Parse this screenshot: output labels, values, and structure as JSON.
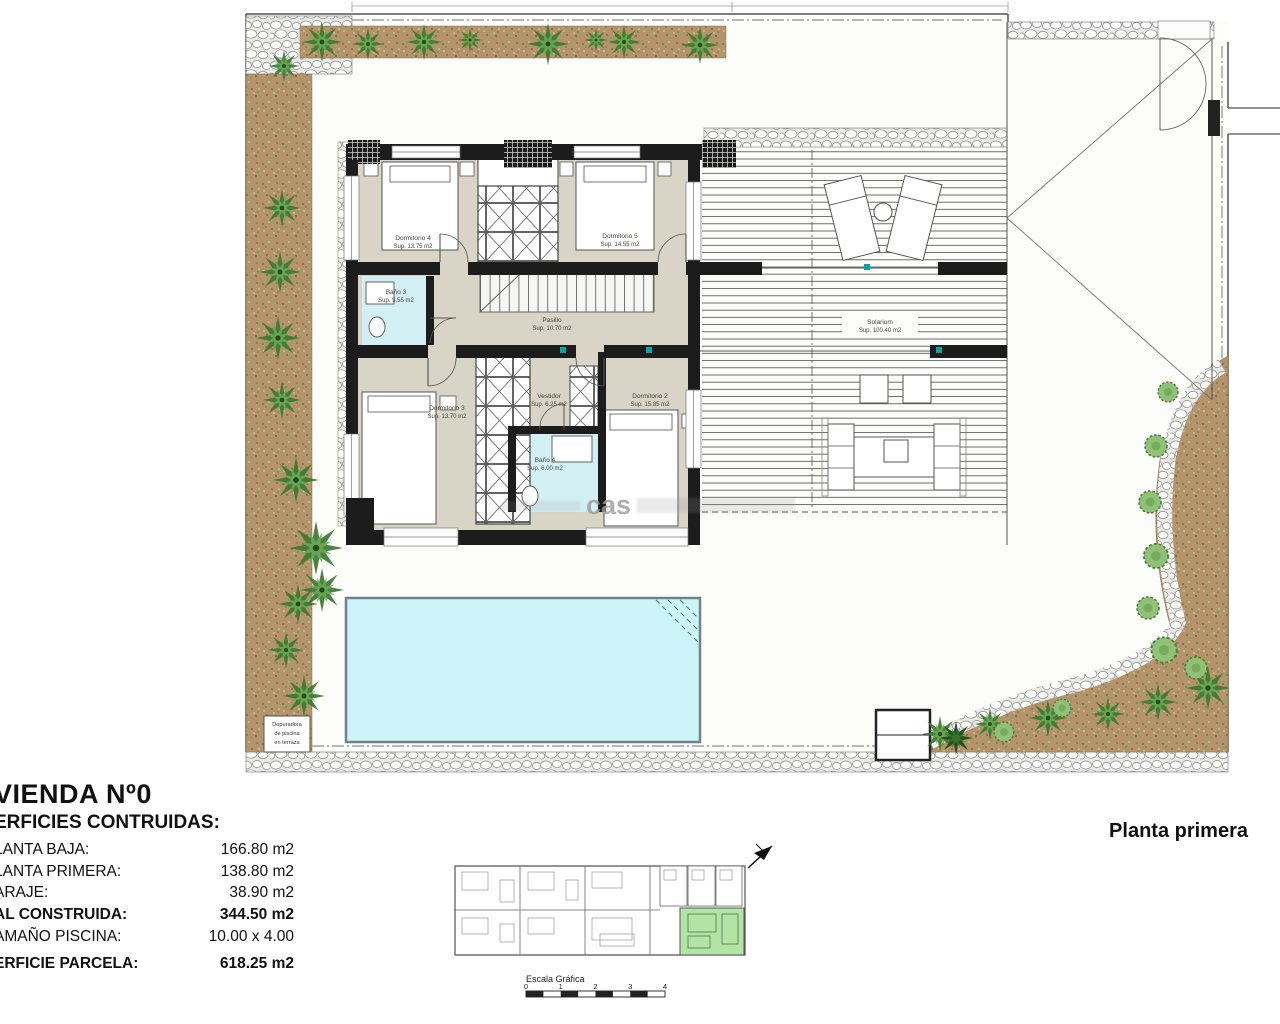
{
  "plan": {
    "floor_label": "Planta primera",
    "watermark": "cas",
    "rooms": [
      {
        "name": "Dormitorio 4",
        "area": "Sup. 13.75 m2"
      },
      {
        "name": "Dormitorio 5",
        "area": "Sup. 14.55 m2"
      },
      {
        "name": "Baño 3",
        "area": "Sup. 5.55 m2"
      },
      {
        "name": "Pasillo",
        "area": "Sup. 10.70 m2"
      },
      {
        "name": "Dormitorio 3",
        "area": "Sup. 13.70 m2"
      },
      {
        "name": "Vestidor",
        "area": "Sup. 6.25 m2"
      },
      {
        "name": "Baño 4",
        "area": "Sup. 6.00 m2"
      },
      {
        "name": "Dormitorio 2",
        "area": "Sup. 15.85 m2"
      },
      {
        "name": "Solarium",
        "area": "Sup. 100.40 m2"
      }
    ],
    "pool_note_lines": [
      "Depuradora",
      "de piscina",
      "en terraza"
    ]
  },
  "summary": {
    "title": "VIENDA Nº0",
    "subtitle": "ERFICIES CONTRUIDAS:",
    "rows": [
      {
        "label": "LANTA BAJA:",
        "value": "166.80 m2"
      },
      {
        "label": "LANTA PRIMERA:",
        "value": "138.80 m2"
      },
      {
        "label": "ARAJE:",
        "value": "38.90 m2"
      },
      {
        "label": "AL CONSTRUIDA:",
        "value": "344.50 m2"
      },
      {
        "label": "AMAÑO PISCINA:",
        "value": "10.00 x 4.00"
      },
      {
        "label": "ERFICIE PARCELA:",
        "value": "618.25 m2"
      }
    ]
  },
  "key_plan": {
    "scale_title": "Escala Gráfica",
    "ticks": [
      "0",
      "1",
      "2",
      "3",
      "4"
    ]
  },
  "colors": {
    "room_fill": "#d8d4c6",
    "bath_fill": "#d2eff4",
    "pool_fill": "#cdf4f8",
    "wall": "#1c1c1c",
    "garden": "#b4946a",
    "highlight_unit": "#b2e5a5",
    "accent_teal": "#00a9a9"
  }
}
